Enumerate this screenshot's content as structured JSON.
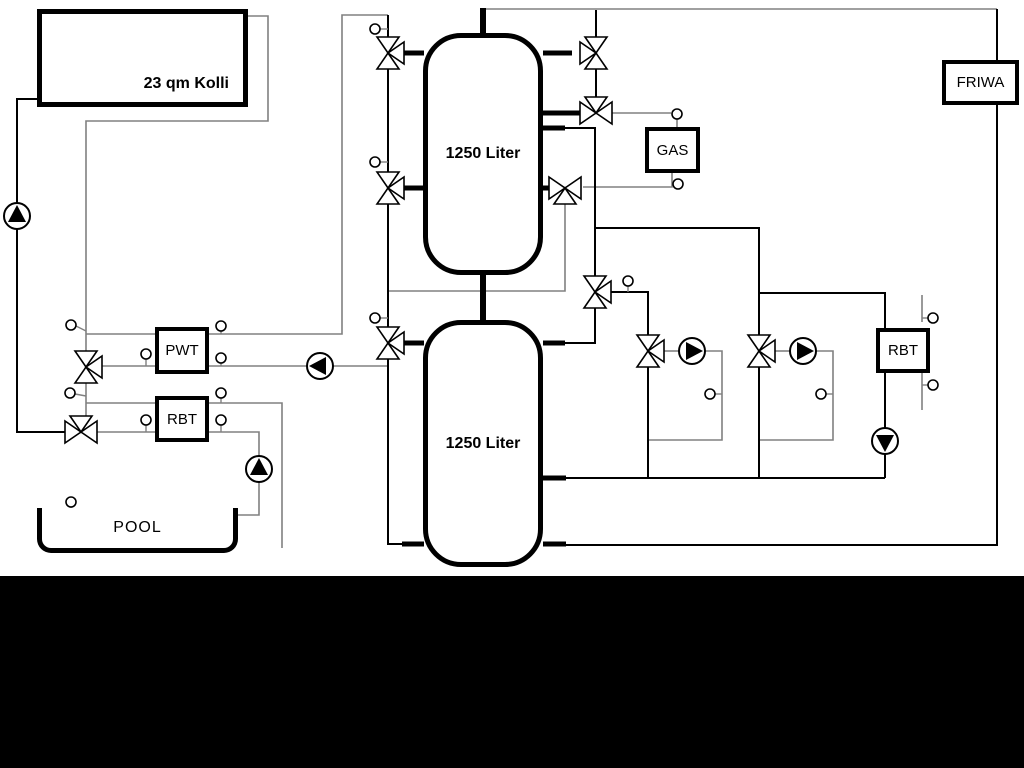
{
  "diagram": {
    "labels": {
      "collector": "23 qm Kolli",
      "tank_top": "1250 Liter",
      "tank_bottom": "1250 Liter",
      "pwt": "PWT",
      "rbt_left": "RBT",
      "gas": "GAS",
      "friwa": "FRIWA",
      "rbt_right": "RBT",
      "pool": "POOL"
    },
    "colors": {
      "pipe_gray": "#808080",
      "pipe_black": "#000000",
      "background": "#ffffff",
      "letterbox": "#000000"
    }
  }
}
